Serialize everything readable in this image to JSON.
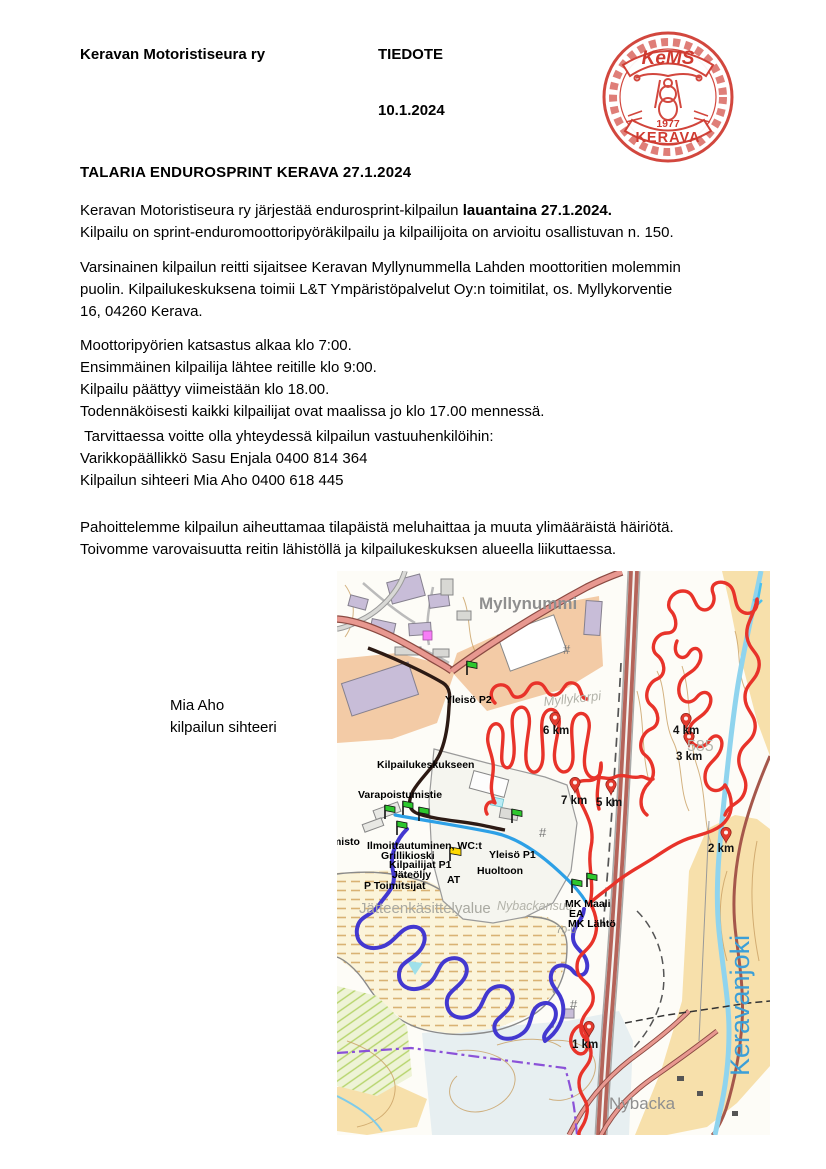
{
  "header": {
    "organization": "Keravan Motoristiseura ry",
    "document_type": "TIEDOTE",
    "date": "10.1.2024"
  },
  "stamp": {
    "club": "KeMS",
    "year": "1977",
    "city": "KERAVA",
    "color": "#cf3a30"
  },
  "title": "TALARIA ENDUROSPRINT KERAVA 27.1.2024",
  "body": {
    "p1_normal": "Keravan Motoristiseura ry järjestää endurosprint-kilpailun ",
    "p1_bold": "lauantaina 27.1.2024.",
    "p1_line2": "Kilpailu on sprint-enduromoottoripyöräkilpailu ja kilpailijoita on arvioitu osallistuvan n. 150.",
    "p2": [
      "Varsinainen kilpailun reitti sijaitsee Keravan Myllynummella Lahden moottoritien molemmin",
      "puolin. Kilpailukeskuksena toimii L&T Ympäristöpalvelut Oy:n toimitilat, os. Myllykorventie",
      "16, 04260 Kerava."
    ],
    "schedule": [
      "Moottoripyörien katsastus alkaa klo 7:00.",
      "Ensimmäinen kilpailija lähtee reitille klo 9:00.",
      "Kilpailu päättyy viimeistään klo 18.00.",
      "Todennäköisesti kaikki kilpailijat ovat maalissa jo klo 17.00 mennessä."
    ],
    "contacts": [
      " Tarvittaessa voitte olla yhteydessä kilpailun vastuuhenkilöihin:",
      "Varikkopäällikkö Sasu Enjala 0400 814 364",
      "Kilpailun sihteeri Mia Aho 0400 618 445"
    ],
    "apology": [
      "Pahoittelemme kilpailun aiheuttamaa tilapäistä meluhaittaa ja muuta ylimääräistä häiriötä.",
      "Toivomme varovaisuutta reitin lähistöllä ja kilpailukeskuksen alueella liikuttaessa."
    ]
  },
  "signature": {
    "name": "Mia Aho",
    "role": "kilpailun sihteeri"
  },
  "map": {
    "labels": {
      "myllynummi": "Myllynummi",
      "myllykorpi": "Myllykorpi",
      "yleiso_p2": "Yleisö P2",
      "kilpailukeskukseen": "Kilpailukeskukseen",
      "varapoistumistie": "Varapoistumistie",
      "toimisto": "Toimisto",
      "ilmoittautuminen": "Ilmoittautuminen, WC:t",
      "grillikioski": "Grillikioski",
      "kilpailijat_p1": "Kilpailijat P1",
      "jateoljy": "Jäteöljy",
      "p_toimitsijat": "P Toimitsijat",
      "at": "AT",
      "huoltoon": "Huoltoon",
      "yleiso_p1": "Yleisö P1",
      "maali": "MK Maali",
      "ea": "EA",
      "mk_lahto": "MK Lähtö",
      "jatteenkasittelyalue": "Jätteenkäsittelyalue",
      "nybackansuu": "Nybackansuu",
      "nybacka": "Nybacka",
      "keravanjoki": "Keravanjoki",
      "elev585": "585",
      "elev70": "70-0"
    },
    "km": {
      "k1": "1 km",
      "k2": "2 km",
      "k3": "3 km",
      "k4": "4 km",
      "k5": "5 km",
      "k6": "6 km",
      "k7": "7 km"
    },
    "symbols": {
      "hash": "#"
    },
    "colors": {
      "track_red": "#e8332a",
      "track_blue_loop": "#4338d0",
      "track_blue_transfer": "#2da0e6",
      "access_dark": "#2c1a14",
      "boundary_purple": "#8b52d8",
      "river_blue": "#8fd4ee",
      "flag_green": "#2ec82e",
      "flag_yellow": "#ffd900",
      "pin_red": "#e23b2e"
    }
  }
}
